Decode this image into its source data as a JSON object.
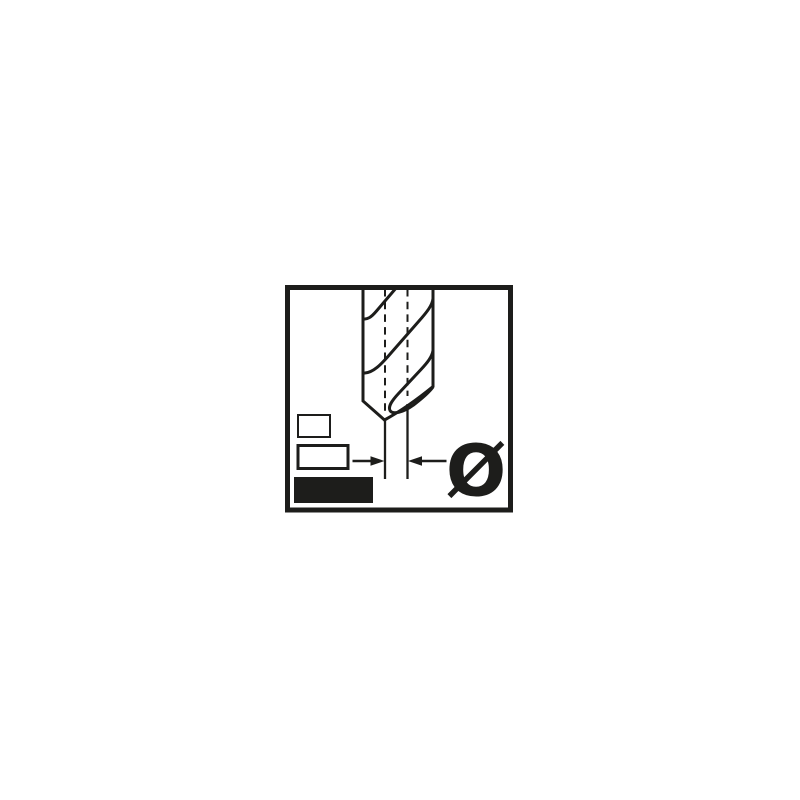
{
  "colors": {
    "ink": "#1d1d1b",
    "paper": "#ffffff"
  },
  "pictogram": {
    "label": "drill-bit-diameter-pictogram",
    "diameter_symbol": "Ø",
    "icons": {
      "drill_bit": "twist-drill-tip-front-view",
      "centerlines": "dashed-vertical-centerlines",
      "dimension": "horizontal-arrows-pointing-inward-at-drill-diameter",
      "size_small": "outlined-rectangle",
      "size_medium": "outlined-rectangle",
      "size_large": "filled-rectangle"
    }
  }
}
